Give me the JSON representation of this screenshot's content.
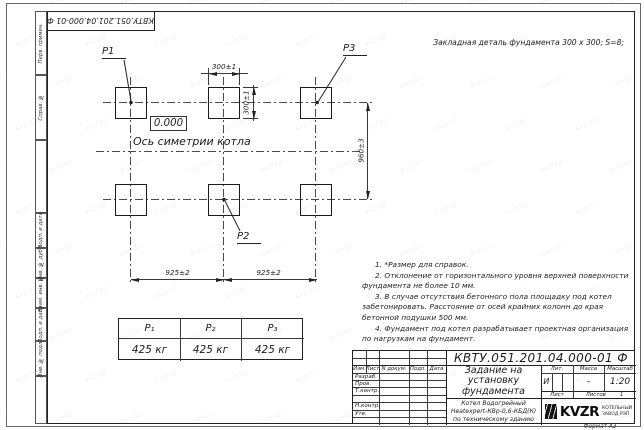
{
  "frame": {
    "doc_number_rotated": "КВТУ.051.201.04.000-01 Ф",
    "format_label": "Формат А3",
    "side_labels": [
      "Перв. примен.",
      "Справ. №",
      "",
      "Подп. и дата",
      "Инв. № дубл.",
      "Взам. инв. №",
      "Подп. и дата",
      "Инв. № подл.",
      ""
    ]
  },
  "drawing": {
    "header_note": "Закладная деталь фундамента  300 х 300;  S=8;",
    "elevation": "0.000",
    "axis_label": "Ось симетрии котла",
    "points": {
      "p1": "Р1",
      "p2": "Р2",
      "p3": "Р3"
    },
    "dims": {
      "top": "300±1",
      "side": "300±1",
      "height": "960±3",
      "span_left": "925±2",
      "span_right": "925±2"
    },
    "notes": [
      "1. *Размер для справок.",
      "2. Отклонение от горизонтального уровня верхней поверхности фундамента не более 10 мм.",
      "3. В случае отсутствия бетонного пола площадку под котел забетонировать. Расстояние от осей крайних колонн до края бетонной подушки 500 мм.",
      "4. Фундамент под котел разрабатывает проектная организация по нагрузкам на фундамент."
    ]
  },
  "load_table": {
    "headers": [
      "Р₁",
      "Р₂",
      "Р₃"
    ],
    "values": [
      "425 кг",
      "425 кг",
      "425 кг"
    ]
  },
  "title_block": {
    "doc_number": "КВТУ.051.201.04.000-01 Ф",
    "title_lines": [
      "Задание на",
      "установку",
      "фундамента"
    ],
    "product_lines": [
      "Котел Водогрейный",
      "Heatexpert-КВр-0,6-КБД(К)",
      "по техническому зданию"
    ],
    "rev_headers": [
      "Изм.",
      "Лист",
      "N докум.",
      "Подп.",
      "Дата"
    ],
    "row_labels": [
      "Разраб.",
      "Пров.",
      "Т.контр.",
      "",
      "Н.контр.",
      "Утв."
    ],
    "stat_headers": [
      "Лит.",
      "Масса",
      "Масштаб"
    ],
    "lit_value": "И",
    "mass_value": "–",
    "scale_value": "1:20",
    "sheet_label": "Лист",
    "sheets_label": "Листов",
    "sheets_value": "1",
    "logo_text": "KVZR",
    "logo_caption": [
      "КОТЕЛЬНЫЙ",
      "ЗАВОД РЭП"
    ]
  },
  "watermark": {
    "text": "kvzr.kz"
  }
}
